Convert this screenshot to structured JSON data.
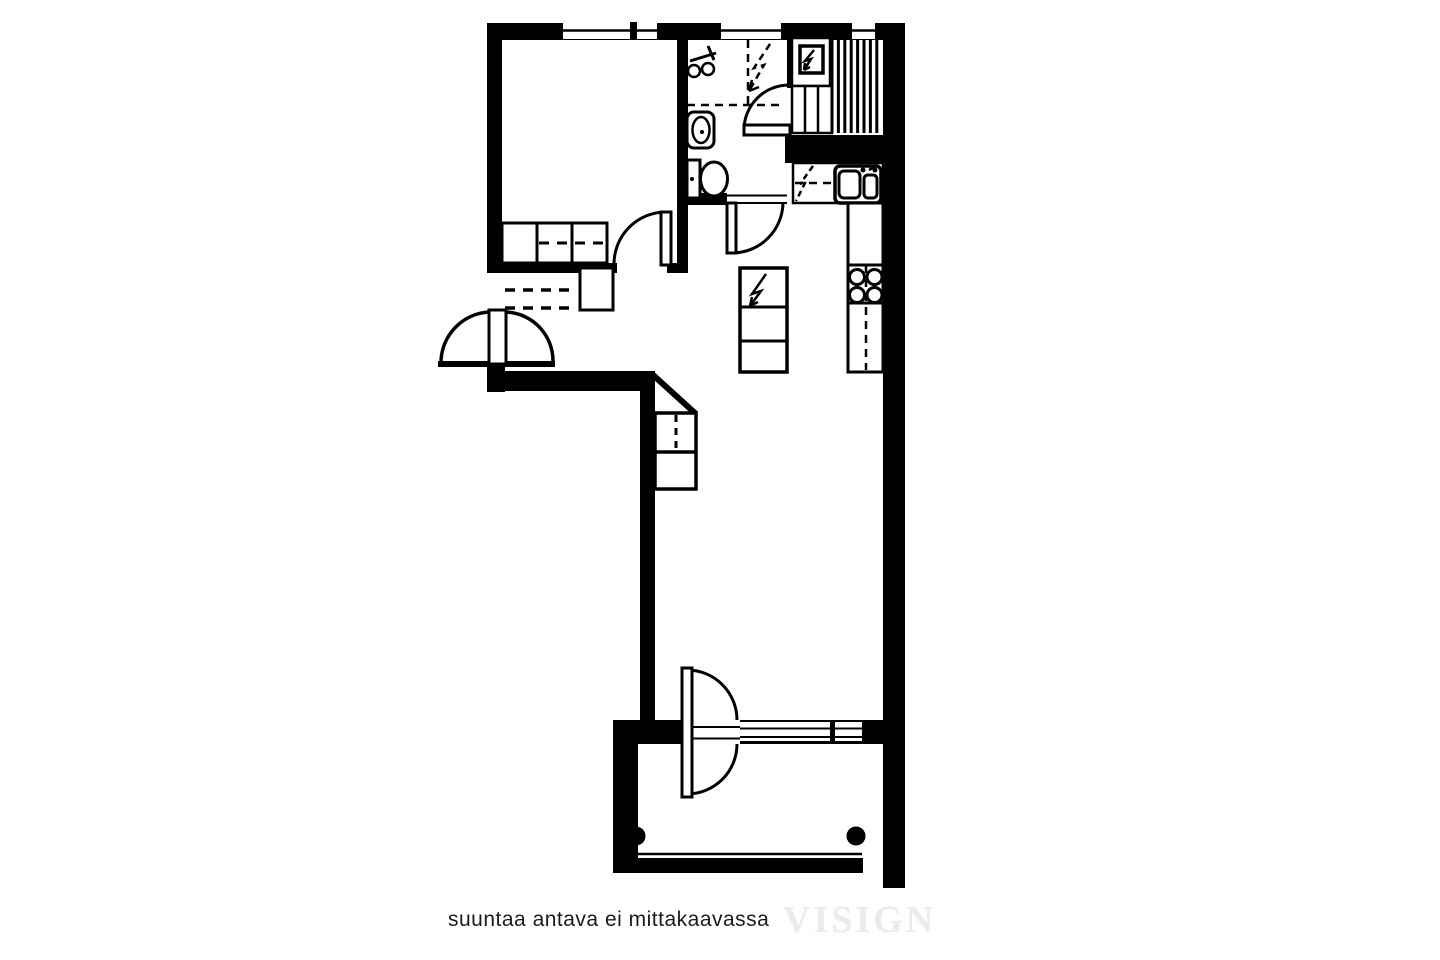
{
  "page": {
    "width": 1440,
    "height": 960,
    "background": "#ffffff"
  },
  "palette": {
    "ink": "#000000",
    "paper": "#ffffff",
    "watermark_color": "#edeaea",
    "caption_color": "#1b1b1b"
  },
  "caption": {
    "disclaimer": "suuntaa antava ei mittakaavassa",
    "watermark": "VISIGN"
  },
  "floorplan": {
    "kind": "apartment-floor-plan",
    "rooms": [
      "bedroom",
      "bathroom",
      "sauna",
      "entry-hall",
      "open-kitchen",
      "living-room",
      "balcony"
    ],
    "doors": [
      "entrance-door",
      "bedroom-door",
      "bathroom-door",
      "sauna-door",
      "balcony-door"
    ],
    "windows_count": 5,
    "fixture_icons": [
      "wardrobe-icon",
      "hall-closet-rail-icon",
      "hall-cabinet-icon",
      "shower-mixer-icon",
      "washing-machine-reservation-icon",
      "washbasin-icon",
      "toilet-icon",
      "sauna-heater-icon",
      "sauna-bench-steps-icon",
      "sauna-benches-icon",
      "dishwasher-reservation-icon",
      "kitchen-sink-icon",
      "cooktop-icon",
      "fridge-freezer-icon",
      "living-room-cabinet-icon",
      "balcony-post-icon"
    ]
  }
}
